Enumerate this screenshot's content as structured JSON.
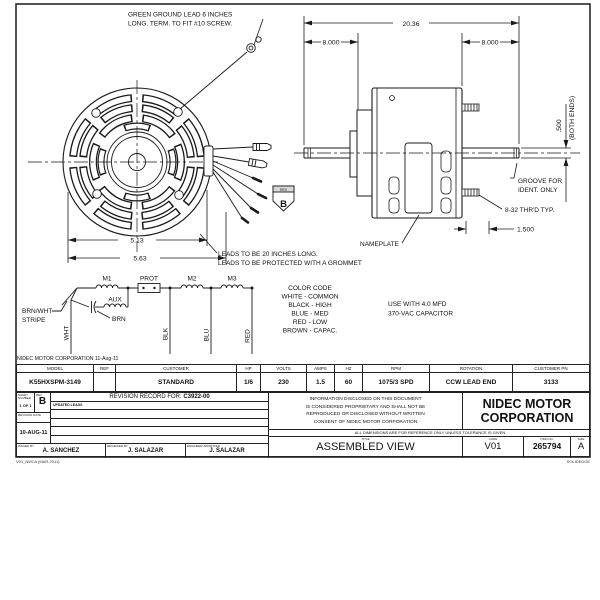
{
  "sheet": {
    "notes": {
      "ground_lead_1": "GREEN GROUND LEAD 6 INCHES",
      "ground_lead_2": "LONG. TERM. TO FIT #10 SCREW.",
      "leads_1": "LEADS TO BE 20 INCHES LONG.",
      "leads_2": "LEADS TO BE PROTECTED WITH A GROMMET",
      "capacitor_1": "USE WITH 4.0 MFD",
      "capacitor_2": "370-VAC CAPACITOR",
      "corp_date": "NIDEC MOTOR CORPORATION 11-Aug-11"
    },
    "color_code": {
      "title": "COLOR CODE",
      "lines": [
        "WHITE - COMMON",
        "BLACK - HIGH",
        "BLUE - MED",
        "RED - LOW",
        "BROWN - CAPAC."
      ]
    },
    "dimensions": {
      "overall": "20.36",
      "left_shaft": "8.000",
      "right_shaft": "8.000",
      "bolt_circle": "5.13",
      "shell": "5.63",
      "shaft_dia": ".500",
      "both_ends": "(BOTH ENDS)",
      "groove_1": "GROOVE FOR",
      "groove_2": "IDENT. ONLY",
      "thread": "8-32 THR'D TYP.",
      "stud": "1.500",
      "nameplate": "NAMEPLATE"
    },
    "schematic": {
      "m1": "M1",
      "prot": "PROT",
      "m2": "M2",
      "m3": "M3",
      "aux": "AUX",
      "brn": "BRN",
      "brnwht_1": "BRN/WHT",
      "brnwht_2": "STRIPE",
      "wht": "WHT",
      "blk": "BLK",
      "blu": "BLU",
      "red": "RED"
    },
    "rev_flag": {
      "label": "REV",
      "value": "B"
    },
    "spec_table": {
      "columns": [
        {
          "header": "MODEL",
          "value": "K55HXSPM-3149"
        },
        {
          "header": "REF",
          "value": ""
        },
        {
          "header": "CUSTOMER",
          "value": "STANDARD"
        },
        {
          "header": "HP",
          "value": "1/6"
        },
        {
          "header": "VOLTS",
          "value": "230"
        },
        {
          "header": "AMPS",
          "value": "1.5"
        },
        {
          "header": "HZ",
          "value": "60"
        },
        {
          "header": "RPM",
          "value": "1075/3 SPD"
        },
        {
          "header": "ROTATION",
          "value": "CCW LEAD END"
        },
        {
          "header": "CUSTOMER PN",
          "value": "3133"
        }
      ]
    },
    "title_block": {
      "sheet_label": "SHEET NUMBER",
      "sheet_value": "1 OF 1",
      "rev_label": "REV",
      "rev_value": "B",
      "record_label": "REVISION RECORD FOR:",
      "record_number": "C3922-00",
      "revision_entry": "UPDATED LEADS",
      "date_label": "REVISION DATE",
      "date_value": "10-AUG-11",
      "issued_label": "ISSUED BY",
      "issued_value": "A. SANCHEZ",
      "reviewed_label": "REVIEWED BY",
      "reviewed_value": "J. SALAZAR",
      "engineer_label": "ENGINEER APPROVED",
      "engineer_value": "J. SALAZAR",
      "proprietary": [
        "INFORMATION DISCLOSED ON THIS DOCUMENT",
        "IS CONSIDERED PROPRIETARY AND SHALL NOT BE",
        "REPRODUCED OR DISCLOSED WITHOUT WRITTEN",
        "CONSENT OF NIDEC MOTOR CORPORATION"
      ],
      "company_1": "NIDEC MOTOR",
      "company_2": "CORPORATION",
      "tolerance_note": "ALL DIMENSIONS ARE FOR REFERENCE ONLY UNLESS TOLERANCE IS GIVEN",
      "title_label": "TITLE",
      "title_value": "ASSEMBLED VIEW",
      "code_label": "CODE",
      "code_value": "V01",
      "item_label": "ITEM NO.",
      "item_value": "265794",
      "size_label": "SIZE",
      "size_value": "A",
      "footer_left": "V01_NMCA (MAR-2011)",
      "footer_right": "SOLIDEDGE"
    }
  }
}
